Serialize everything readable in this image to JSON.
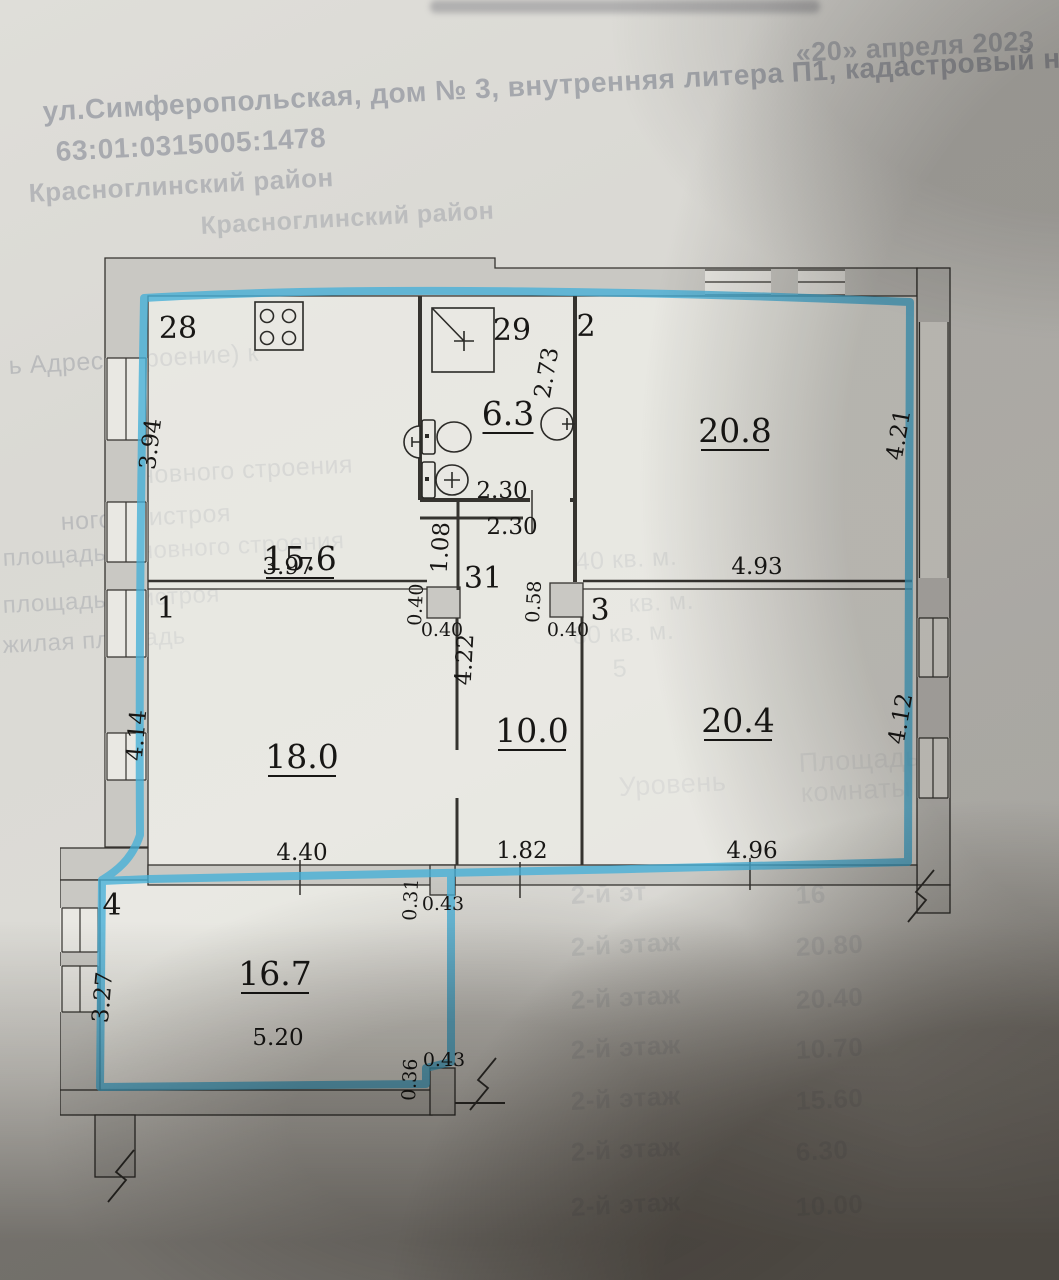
{
  "page": {
    "date_note": "«20» апреля 2023",
    "address_line": "ул.Симферопольская, дом № 3, внутренняя литера П1, кадастровый ном",
    "cadastral_number": "63:01:0315005:1478",
    "district_line1": "Красноглинский район",
    "district_line2": "Красноглинский район",
    "fragments": [
      {
        "t": "ь Адрес (строение) к",
        "x": 8,
        "y": 352,
        "s": 25,
        "o": 0.3
      },
      {
        "t": "основного строения",
        "x": 112,
        "y": 463,
        "s": 25,
        "o": 0.3
      },
      {
        "t": "ного пристроя",
        "x": 60,
        "y": 508,
        "s": 25,
        "o": 0.28
      },
      {
        "t": "площадь основного строения",
        "x": 2,
        "y": 545,
        "s": 24,
        "o": 0.25
      },
      {
        "t": "площадь пристроя",
        "x": 2,
        "y": 592,
        "s": 24,
        "o": 0.25
      },
      {
        "t": "жилая площадь",
        "x": 2,
        "y": 632,
        "s": 24,
        "o": 0.25
      },
      {
        "t": "40 кв. м.",
        "x": 575,
        "y": 548,
        "s": 25,
        "o": 0.28
      },
      {
        "t": "кв. м.",
        "x": 628,
        "y": 590,
        "s": 25,
        "o": 0.26
      },
      {
        "t": "80 кв. м.",
        "x": 572,
        "y": 622,
        "s": 25,
        "o": 0.26
      },
      {
        "t": "5",
        "x": 612,
        "y": 655,
        "s": 25,
        "o": 0.26
      },
      {
        "t": "Уровень",
        "x": 618,
        "y": 772,
        "s": 27,
        "o": 0.22
      },
      {
        "t": "Площадь",
        "x": 798,
        "y": 748,
        "s": 27,
        "o": 0.22
      },
      {
        "t": "комнаты",
        "x": 800,
        "y": 778,
        "s": 27,
        "o": 0.22
      }
    ],
    "ghost_table": {
      "level_label": "2-й этаж",
      "rows": [
        {
          "level": "2-й эт",
          "value": "16",
          "y": 880
        },
        {
          "level": "2-й этаж",
          "value": "20.80",
          "y": 932
        },
        {
          "level": "2-й этаж",
          "value": "20.40",
          "y": 985
        },
        {
          "level": "2-й этаж",
          "value": "10.70",
          "y": 1035
        },
        {
          "level": "2-й этаж",
          "value": "15.60",
          "y": 1086
        },
        {
          "level": "2-й этаж",
          "value": "6.30",
          "y": 1137
        },
        {
          "level": "2-й этаж",
          "value": "10.00",
          "y": 1192
        }
      ]
    }
  },
  "plan": {
    "colors": {
      "highlight": "#45b0d8",
      "wall_fill": "#c9c8c3",
      "ink": "#35332f"
    },
    "rooms": [
      {
        "number": "28",
        "area_sqm": "15.6"
      },
      {
        "number": "29",
        "area_sqm": "6.3"
      },
      {
        "number": "2",
        "area_sqm": "20.8"
      },
      {
        "number": "1",
        "area_sqm": "18.0"
      },
      {
        "number": "31",
        "area_sqm": ""
      },
      {
        "number": "3",
        "area_sqm": "20.4"
      },
      {
        "number": "",
        "area_sqm": "10.0"
      },
      {
        "number": "4",
        "area_sqm": "16.7"
      }
    ],
    "labels": [
      {
        "t": "28",
        "k": "num",
        "x": 118,
        "y": 88
      },
      {
        "t": "29",
        "k": "num",
        "x": 452,
        "y": 90
      },
      {
        "t": "2",
        "k": "num",
        "x": 526,
        "y": 86
      },
      {
        "t": "1",
        "k": "num",
        "x": 106,
        "y": 368
      },
      {
        "t": "31",
        "k": "num",
        "x": 423,
        "y": 338
      },
      {
        "t": "3",
        "k": "num",
        "x": 540,
        "y": 370
      },
      {
        "t": "4",
        "k": "num",
        "x": 52,
        "y": 665
      },
      {
        "t": "15.6",
        "k": "area",
        "x": 240,
        "y": 320
      },
      {
        "t": "6.3",
        "k": "area",
        "x": 448,
        "y": 175
      },
      {
        "t": "20.8",
        "k": "area",
        "x": 675,
        "y": 192
      },
      {
        "t": "18.0",
        "k": "area",
        "x": 242,
        "y": 518
      },
      {
        "t": "10.0",
        "k": "area",
        "x": 472,
        "y": 492
      },
      {
        "t": "20.4",
        "k": "area",
        "x": 678,
        "y": 482
      },
      {
        "t": "16.7",
        "k": "area",
        "x": 215,
        "y": 735
      },
      {
        "t": "3.94",
        "k": "dim",
        "x": 98,
        "y": 195,
        "r": -83
      },
      {
        "t": "2.73",
        "k": "dim",
        "x": 494,
        "y": 124,
        "r": -80
      },
      {
        "t": "2.30",
        "k": "dim",
        "x": 442,
        "y": 248
      },
      {
        "t": "2.30",
        "k": "dim",
        "x": 452,
        "y": 284
      },
      {
        "t": "4.21",
        "k": "dim",
        "x": 846,
        "y": 186,
        "r": -80
      },
      {
        "t": "4.93",
        "k": "dim",
        "x": 697,
        "y": 324
      },
      {
        "t": "3.97",
        "k": "dim",
        "x": 228,
        "y": 324
      },
      {
        "t": "1.08",
        "k": "dim",
        "x": 388,
        "y": 298,
        "r": -87
      },
      {
        "t": "0.40",
        "k": "dims",
        "x": 362,
        "y": 355,
        "r": -87
      },
      {
        "t": "0.40",
        "k": "dims",
        "x": 382,
        "y": 386
      },
      {
        "t": "0.58",
        "k": "dims",
        "x": 480,
        "y": 352,
        "r": -87
      },
      {
        "t": "0.40",
        "k": "dims",
        "x": 508,
        "y": 386
      },
      {
        "t": "4.22",
        "k": "dim",
        "x": 412,
        "y": 410,
        "r": -87
      },
      {
        "t": "4.14",
        "k": "dim",
        "x": 84,
        "y": 486,
        "r": -85
      },
      {
        "t": "4.12",
        "k": "dim",
        "x": 848,
        "y": 470,
        "r": -80
      },
      {
        "t": "4.40",
        "k": "dim",
        "x": 242,
        "y": 610
      },
      {
        "t": "1.82",
        "k": "dim",
        "x": 462,
        "y": 608
      },
      {
        "t": "4.96",
        "k": "dim",
        "x": 692,
        "y": 608
      },
      {
        "t": "0.31",
        "k": "dims",
        "x": 357,
        "y": 650,
        "r": -87
      },
      {
        "t": "0.43",
        "k": "dims",
        "x": 383,
        "y": 660
      },
      {
        "t": "5.20",
        "k": "dim",
        "x": 218,
        "y": 795
      },
      {
        "t": "3.27",
        "k": "dim",
        "x": 50,
        "y": 748,
        "r": -85
      },
      {
        "t": "0.36",
        "k": "dims",
        "x": 356,
        "y": 830,
        "r": -87
      },
      {
        "t": "0.43",
        "k": "dims",
        "x": 384,
        "y": 816
      }
    ]
  }
}
